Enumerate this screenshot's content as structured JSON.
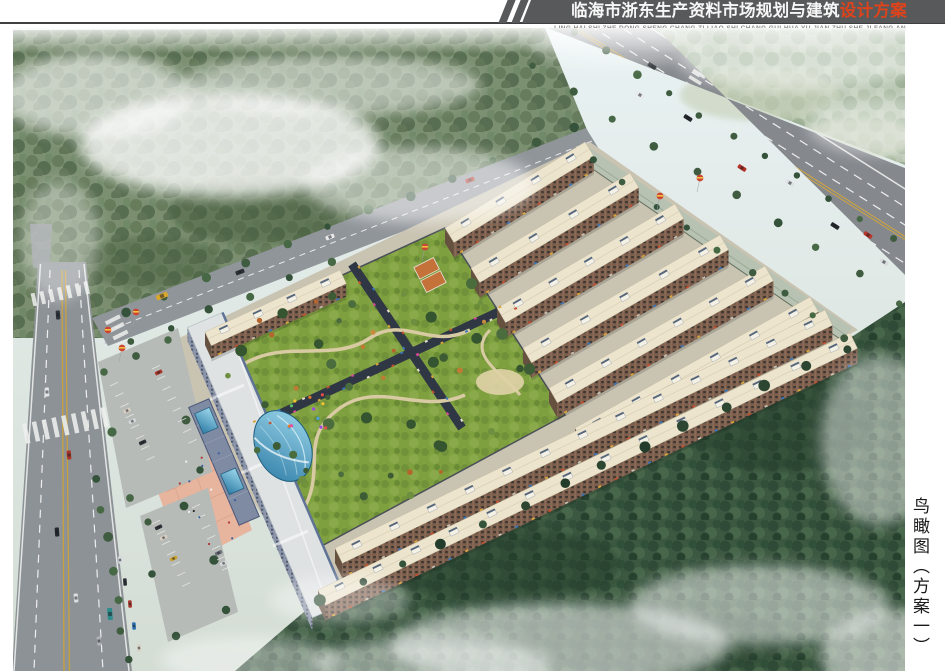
{
  "header": {
    "title_main": "临海市浙东生产资料市场规划与建筑",
    "title_accent": "设计方案",
    "pinyin": "LING HAI SHI ZHE DONG SHENG CHANG ZI LIAO SHI CHANG GUI HUA YU JIAN ZHU SHE JI FANG AN",
    "band_color": "#58595b",
    "accent_color": "#e0431a"
  },
  "side_caption": {
    "text": "鸟瞰图（方案一）"
  },
  "rendering": {
    "palette": {
      "mist": "#ffffff",
      "forest": "#3e5a42",
      "forest_far": "#aebfa6",
      "road": "#8d9297",
      "roof_cream": "#ece4cd",
      "facade_brown": "#7a5c4c",
      "lawn_green": "#7fa03e",
      "glass_blue": "#4fa8cc",
      "plaza_pink": "#e7b49e",
      "lane_yellow": "#c9a13b"
    }
  }
}
